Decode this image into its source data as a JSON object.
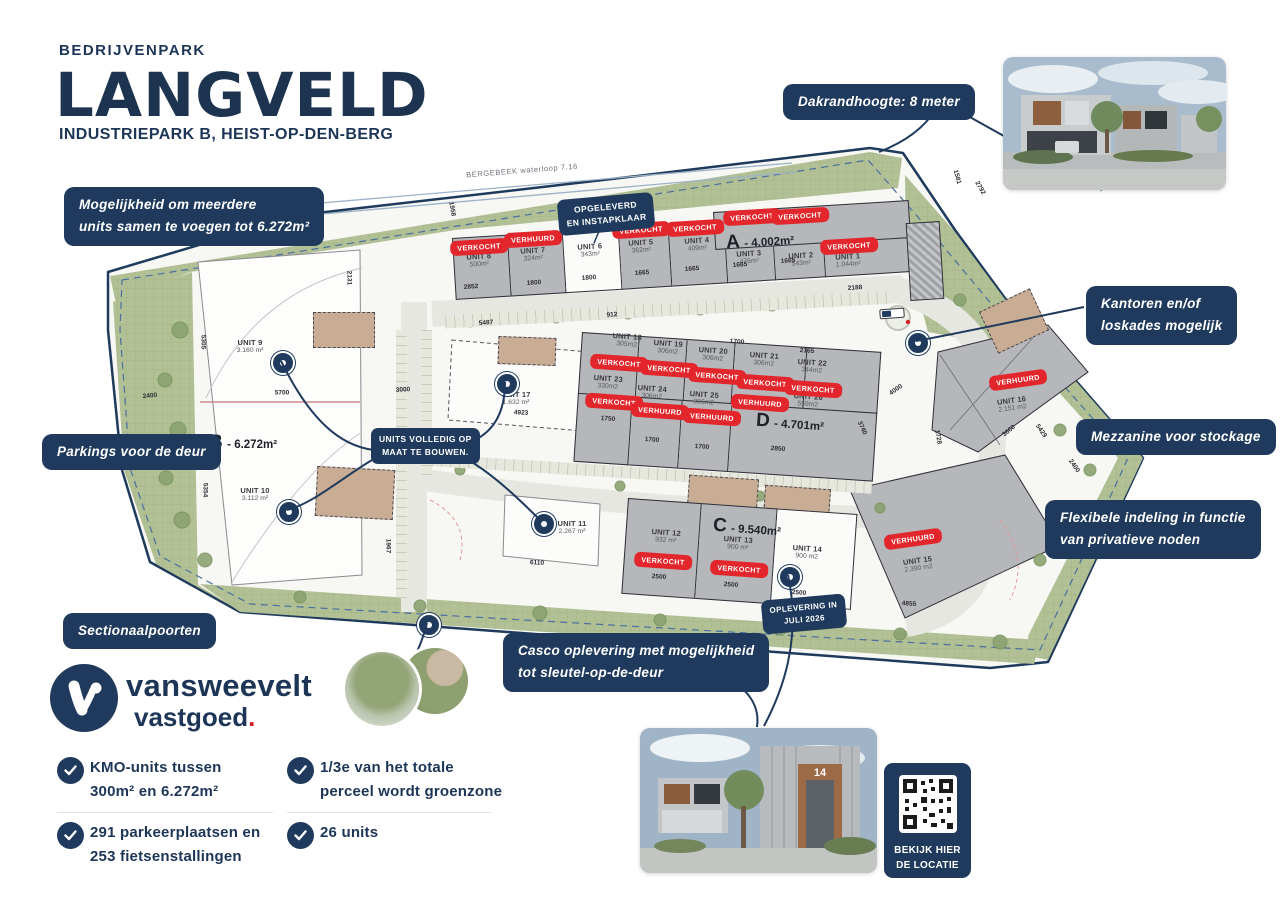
{
  "header": {
    "kicker": "BEDRIJVENPARK",
    "title": "LANGVELD",
    "subtitle": "INDUSTRIEPARK B, HEIST-OP-DEN-BERG"
  },
  "callouts": {
    "merge_1": "Mogelijkheid om meerdere",
    "merge_2": "units samen te voegen tot 6.272m²",
    "roof": "Dakrandhoogte: 8 meter",
    "offices_1": "Kantoren en/of",
    "offices_2": "loskades mogelijk",
    "mezzanine": "Mezzanine voor stockage",
    "flexible_1": "Flexibele indeling in functie",
    "flexible_2": "van privatieve noden",
    "parking": "Parkings voor de deur",
    "sectional": "Sectionaalpoorten",
    "casco_1": "Casco oplevering met mogelijkheid",
    "casco_2": "tot sleutel-op-de-deur",
    "custom_1": "UNITS VOLLEDIG OP",
    "custom_2": "MAAT TE BOUWEN.",
    "delivered_1": "OPGELEVERD",
    "delivered_2": "EN INSTAPKLAAR",
    "delivery_1": "OPLEVERING IN",
    "delivery_2": "JULI 2026"
  },
  "map": {
    "waterway": "BERGEBEEK waterloop 7.16",
    "blocks": {
      "a": {
        "letter": "A",
        "area": "- 4.002m²"
      },
      "b": {
        "letter": "B",
        "area": "- 6.272m²"
      },
      "c": {
        "letter": "C",
        "area": "- 9.540m²"
      },
      "d": {
        "letter": "D",
        "area": "- 4.701m²"
      }
    },
    "units": [
      {
        "name": "UNIT 1",
        "area": "1.044m²",
        "status": "VERKOCHT"
      },
      {
        "name": "UNIT 2",
        "area": "543m²",
        "status": "VERKOCHT"
      },
      {
        "name": "UNIT 3",
        "area": "476m²",
        "status": "VERKOCHT"
      },
      {
        "name": "UNIT 4",
        "area": "409m²",
        "status": "VERKOCHT"
      },
      {
        "name": "UNIT 5",
        "area": "362m²",
        "status": "VERKOCHT"
      },
      {
        "name": "UNIT 6",
        "area": "343m²",
        "status": ""
      },
      {
        "name": "UNIT 7",
        "area": "324m²",
        "status": "VERHUURD"
      },
      {
        "name": "UNIT 8",
        "area": "500m²",
        "status": "VERKOCHT"
      },
      {
        "name": "UNIT 9",
        "area": "3.160 m²",
        "status": ""
      },
      {
        "name": "UNIT 10",
        "area": "3.112 m²",
        "status": ""
      },
      {
        "name": "UNIT 11",
        "area": "2.267 m²",
        "status": ""
      },
      {
        "name": "UNIT 12",
        "area": "932 m²",
        "status": "VERKOCHT"
      },
      {
        "name": "UNIT 13",
        "area": "900 m²",
        "status": "VERKOCHT"
      },
      {
        "name": "UNIT 14",
        "area": "900 m2",
        "status": ""
      },
      {
        "name": "UNIT 15",
        "area": "2.390 m2",
        "status": "VERHUURD"
      },
      {
        "name": "UNIT 16",
        "area": "2.151 m2",
        "status": "VERHUURD"
      },
      {
        "name": "UNIT 17",
        "area": "1.632 m²",
        "status": ""
      },
      {
        "name": "UNIT 18",
        "area": "305m2",
        "status": "VERKOCHT"
      },
      {
        "name": "UNIT 19",
        "area": "306m2",
        "status": "VERKOCHT"
      },
      {
        "name": "UNIT 20",
        "area": "306m2",
        "status": "VERKOCHT"
      },
      {
        "name": "UNIT 21",
        "area": "306m2",
        "status": "VERKOCHT"
      },
      {
        "name": "UNIT 22",
        "area": "344m2",
        "status": "VERKOCHT"
      },
      {
        "name": "UNIT 23",
        "area": "330m2",
        "status": "VERKOCHT"
      },
      {
        "name": "UNIT 24",
        "area": "306m2",
        "status": "VERHUURD"
      },
      {
        "name": "UNIT 25",
        "area": "306m2",
        "status": "VERHUURD"
      },
      {
        "name": "UNIT 26",
        "area": "559m2",
        "status": "VERHUURD"
      }
    ],
    "dims": [
      "2852",
      "1800",
      "1800",
      "1665",
      "1665",
      "1665",
      "1665",
      "2188",
      "912",
      "5487",
      "2131",
      "5305",
      "5700",
      "3000",
      "2400",
      "5354",
      "1967",
      "6110",
      "4923",
      "1750",
      "1700",
      "1700",
      "2850",
      "2165",
      "1700",
      "3740",
      "2500",
      "2500",
      "2500",
      "4855",
      "3600",
      "4000",
      "5429",
      "2400",
      "1728",
      "1581",
      "2792",
      "1958"
    ]
  },
  "brand": {
    "name": "vansweevelt",
    "sub": "vastgoed",
    "dot": "."
  },
  "features": [
    {
      "line1": "KMO-units tussen",
      "line2": "300m² en 6.272m²"
    },
    {
      "line1": "291 parkeerplaatsen en",
      "line2": "253 fietsenstallingen"
    },
    {
      "line1": "1/3e van het totale",
      "line2": "perceel wordt groenzone"
    },
    {
      "line1": "26 units",
      "line2": ""
    }
  ],
  "qr": {
    "line1": "BEKIJK HIER",
    "line2": "DE LOCATIE"
  },
  "photo": {
    "unit_number": "14"
  }
}
